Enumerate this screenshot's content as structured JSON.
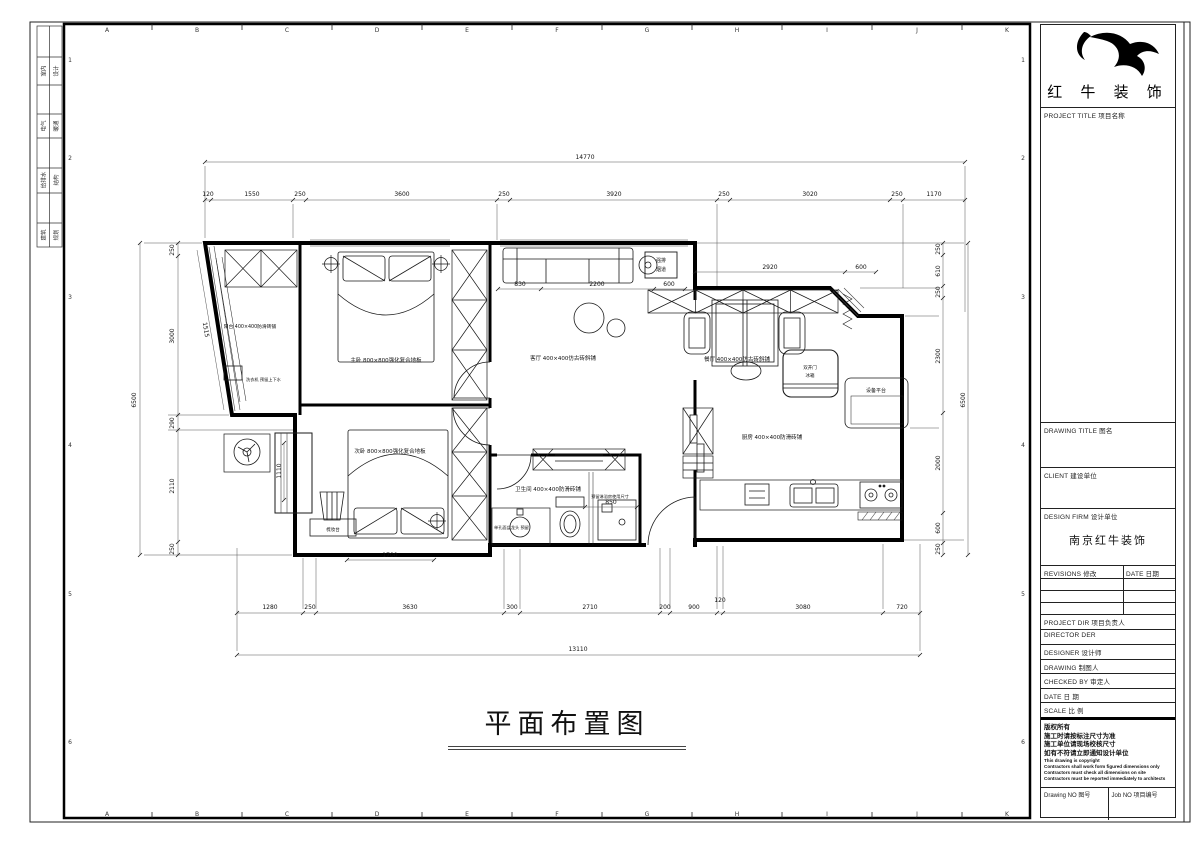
{
  "sheet": {
    "ruler_letters": [
      "A",
      "B",
      "C",
      "D",
      "E",
      "F",
      "G",
      "H",
      "I",
      "J",
      "K"
    ],
    "side_numbers": [
      "1",
      "2",
      "3",
      "4",
      "5",
      "6"
    ],
    "disciplines": [
      {
        "left": "室内",
        "right": "设计"
      },
      {
        "left": "电气",
        "right": "暖通"
      },
      {
        "left": "给排水",
        "right": "结构"
      },
      {
        "left": "建筑",
        "right": "规划"
      }
    ]
  },
  "titleblock": {
    "brand": "红 牛 装 饰",
    "project_title_label": "PROJECT TITLE 项目名称",
    "drawing_title_label": "DRAWING TITLE 图名",
    "client_label": "CLIENT 建设单位",
    "design_firm_label": "DESIGN FIRM 设计单位",
    "design_firm_value": "南京红牛装饰",
    "revisions_label": "REVISIONS 修改",
    "revisions_date_label": "DATE 日期",
    "project_dir_label": "PROJECT DIR 项目负责人",
    "director_label": "DIRECTOR DER",
    "designer_label": "DESIGNER 设计师",
    "drawing_by_label": "DRAWING 制图人",
    "checked_by_label": "CHECKED BY 审定人",
    "date_label": "DATE 日 期",
    "scale_label": "SCALE 比 例",
    "copyright_zh": [
      "版权所有",
      "施工时请按标注尺寸为准",
      "施工单位请现场校核尺寸",
      "如有不符请立即通知设计单位"
    ],
    "copyright_en": [
      "This drawing is copyright",
      "Contractors shall work form figured dimensions only",
      "Contractors must check all dimensions on site",
      "Contractors must be reported immediately to architects"
    ],
    "drawing_no_label": "Drawing NO 图号",
    "job_no_label": "Job NO 项目编号"
  },
  "plan": {
    "title": "平面布置图",
    "rooms": {
      "balcony": "阳台 400×400防滑砖铺",
      "master": "主卧 800×800强化复合地板",
      "bedroom2": "次卧 800×800强化复合地板",
      "living": "客厅 400×400仿古砖斜铺",
      "dining": "餐厅 400×400仿古砖斜铺",
      "kitchen": "厨房 400×400防滑砖铺",
      "bathroom": "卫生间 400×400防滑砖铺",
      "platform": "设备平台",
      "vent1": "强排",
      "vent2": "烟道",
      "dresser": "梳妆台",
      "fridge1": "双开门",
      "fridge2": "冰箱",
      "washer_note": "洗衣机 预留上下水",
      "shower_note": "预留淋浴房使用尺寸",
      "basin_note": "单孔面盆龙头 预留"
    },
    "dims": {
      "top_overall": "14770",
      "top": [
        "120",
        "1550",
        "250",
        "3600",
        "250",
        "3920",
        "250",
        "3020",
        "250",
        "1170"
      ],
      "bottom": [
        "1280",
        "250",
        "3630",
        "300",
        "2710",
        "200",
        "900",
        "120",
        "3080",
        "720"
      ],
      "bottom_overall": "13110",
      "left": [
        "250",
        "3000",
        "290",
        "2110",
        "250"
      ],
      "left_overall": "6500",
      "left_diag": "1515",
      "right": [
        "250",
        "610",
        "250",
        "2300",
        "2000",
        "600",
        "250"
      ],
      "right_overall": "6500",
      "sofa": [
        "830",
        "2200",
        "600"
      ],
      "dining": [
        "2920",
        "600"
      ],
      "bath": "850",
      "bed2": "1700",
      "bay": "1110"
    }
  }
}
